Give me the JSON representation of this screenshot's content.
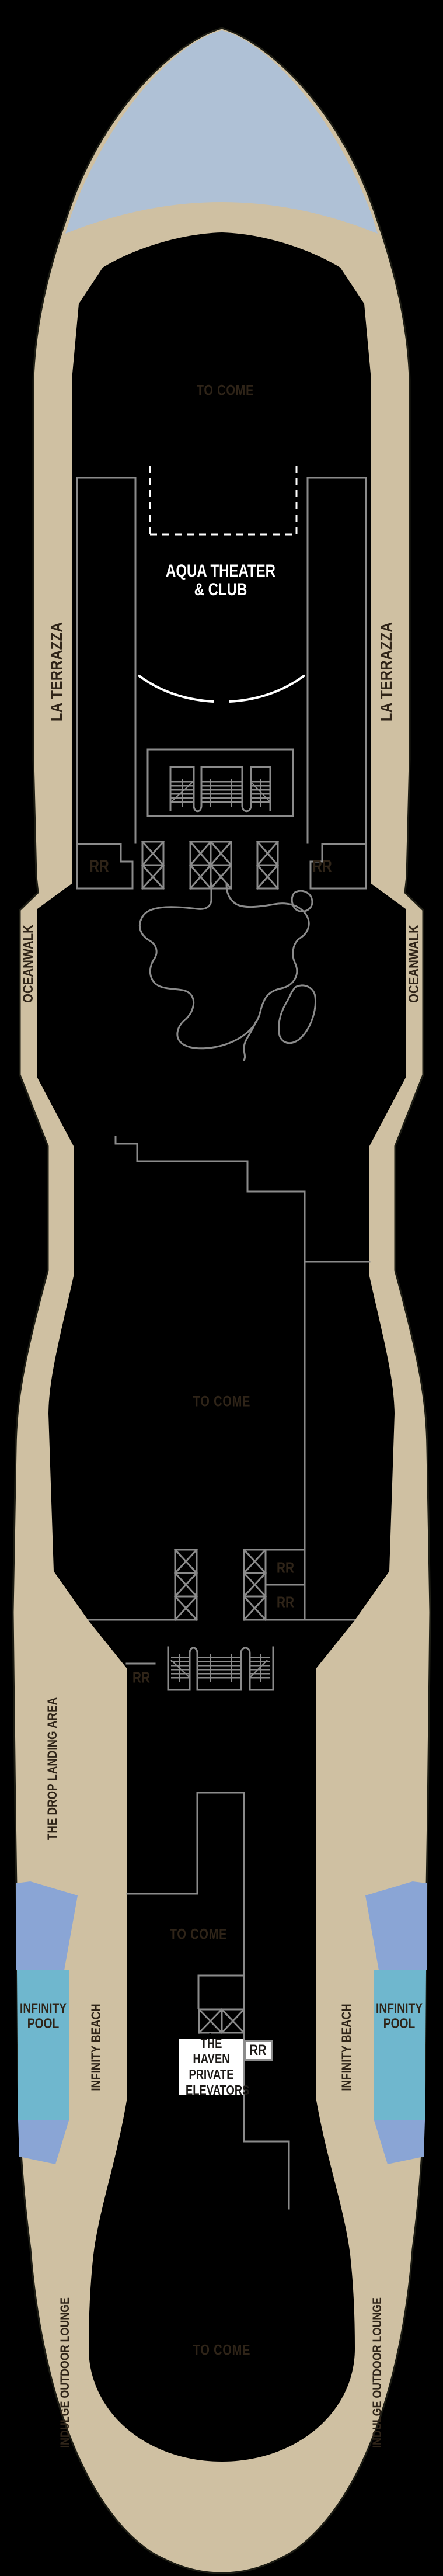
{
  "deck_plan": {
    "venues": {
      "to_come": "TO COME",
      "aqua_theater_line1": "AQUA THEATER",
      "aqua_theater_line2": "& CLUB",
      "la_terrazza": "LA TERRAZZA",
      "oceanwalk": "OCEANWALK",
      "restroom": "RR",
      "drop_landing": "THE DROP LANDING AREA",
      "infinity_beach": "INFINITY BEACH",
      "infinity_pool_line1": "INFINITY",
      "infinity_pool_line2": "POOL",
      "haven_line1": "THE HAVEN",
      "haven_line2": "PRIVATE",
      "haven_line3": "ELEVATORS",
      "indulge_lounge": "INDULGE OUTDOOR LOUNGE"
    },
    "colors": {
      "background": "#000000",
      "hull_tan": "#cfc0a2",
      "hull_outline": "#1c1c14",
      "bow_blue": "#afc1d6",
      "pool_periwinkle": "#8aa5d5",
      "pool_teal": "#6fb7ce",
      "wall_gray": "#8b8b8b",
      "label_brown": "#2f2418",
      "label_white": "#ffffff"
    }
  }
}
